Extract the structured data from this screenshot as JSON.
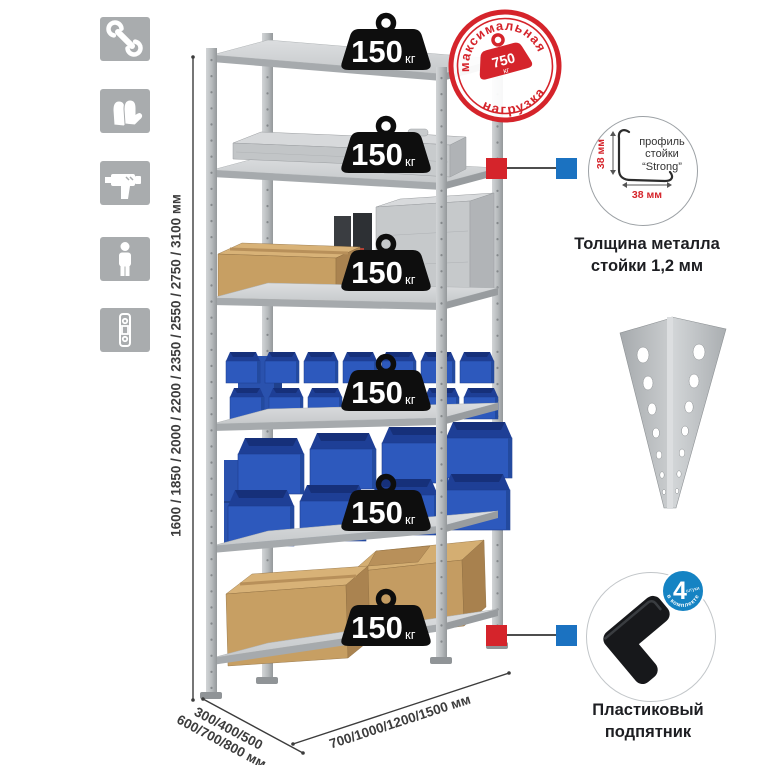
{
  "sidebar": {
    "icons": [
      {
        "name": "wrench-icon"
      },
      {
        "name": "gloves-icon"
      },
      {
        "name": "drill-icon"
      },
      {
        "name": "person-icon"
      },
      {
        "name": "fastener-strip-icon"
      }
    ]
  },
  "dims": {
    "height": "1600 / 1850 / 2000 / 2200 / 2350 / 2550 / 2750 / 3100 мм",
    "depth_line1": "300/400/500",
    "depth_line2": "600/700/800 мм",
    "width": "700/1000/1200/1500 мм"
  },
  "badges": [
    {
      "value": "150",
      "unit": "кг"
    },
    {
      "value": "150",
      "unit": "кг"
    },
    {
      "value": "150",
      "unit": "кг"
    },
    {
      "value": "150",
      "unit": "кг"
    },
    {
      "value": "150",
      "unit": "кг"
    },
    {
      "value": "150",
      "unit": "кг"
    }
  ],
  "stamp": {
    "arc_top": "максимальная",
    "arc_bottom": "нагрузка",
    "value": "750",
    "unit": "кг"
  },
  "profile": {
    "line1": "профиль",
    "line2": "стойки",
    "line3": "“Strong”",
    "dim_v": "38 мм",
    "dim_h": "38 мм",
    "caption1": "Толщина металла",
    "caption2": "стойки 1,2 мм"
  },
  "foot": {
    "badge_value": "4",
    "badge_word": "штуки",
    "badge_arc": "в комплекте",
    "caption1": "Пластиковый",
    "caption2": "подпятник"
  },
  "colors": {
    "red": "#d5242b",
    "blue": "#1b72c1",
    "bin_blue": "#2d59bd",
    "metal": "#c6c9cb",
    "icon_gray": "#a9acae"
  }
}
